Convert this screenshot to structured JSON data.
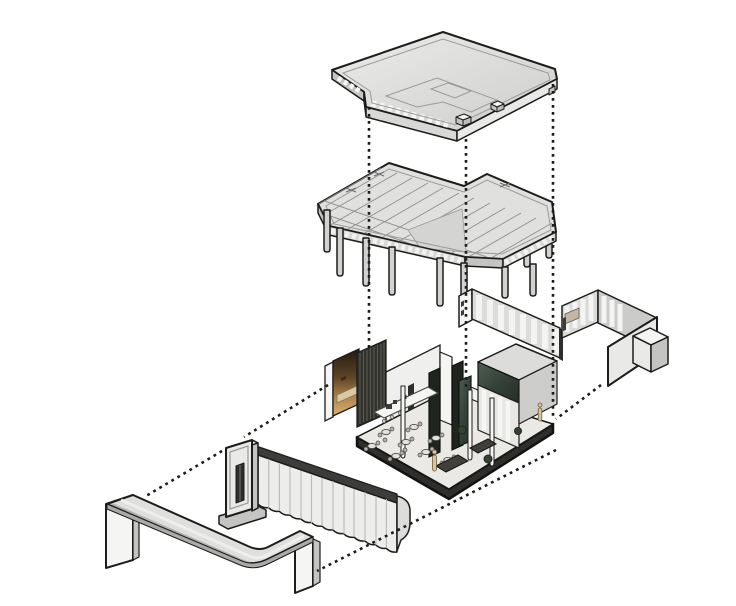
{
  "diagram": {
    "type": "exploded-axonometric-diagram",
    "subject": "building-layer-breakdown",
    "layers": [
      {
        "id": "roof",
        "name": "roof-slab"
      },
      {
        "id": "structure",
        "name": "structural-frame-with-columns"
      },
      {
        "id": "walls",
        "name": "partition-wall-assembly"
      },
      {
        "id": "interior",
        "name": "furnished-interior-on-plinth"
      },
      {
        "id": "facade",
        "name": "fluted-facade-wall-with-entry-portal"
      },
      {
        "id": "canopy",
        "name": "entry-signage-canopy"
      }
    ],
    "connectors": {
      "style": "dotted",
      "count": 7
    }
  },
  "colors": {
    "background": "#ffffff",
    "outline": "#1c1c1a",
    "fill_light": "#e9e9e7",
    "fill_mid": "#d8d8d6",
    "fill_shade": "#c4c4c2",
    "fill_white": "#f5f5f3",
    "fascia_dark": "#3c3c3a",
    "plinth_dark": "#2e2e2c",
    "slat_dark": "#32322d",
    "marble_green_light": "#4f5e52",
    "marble_green_dark": "#242e26",
    "amber_dark": "#231a11",
    "amber_light": "#d9b272",
    "bench_tan": "#d8c8a5"
  }
}
